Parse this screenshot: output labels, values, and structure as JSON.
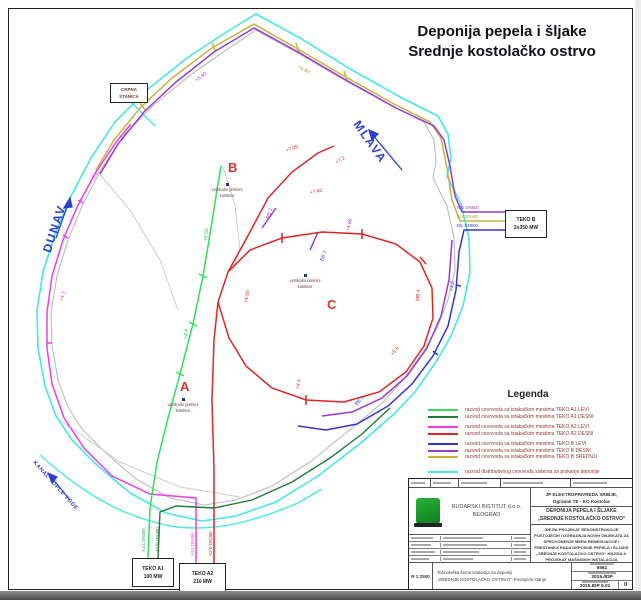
{
  "title": {
    "line1": "Deponija pepela i šljake",
    "line2": "Srednje kostolačko ostrvo"
  },
  "colors": {
    "teko_a1_levi": "#2ee05a",
    "teko_a1_desni": "#1f7a33",
    "teko_a2_levi": "#ee3cee",
    "teko_a2_desni": "#e02424",
    "teko_b_levi": "#3434d0",
    "teko_b_desni": "#9a3ad0",
    "teko_b_srednji": "#c8b23c",
    "distributivni": "#44e8e8",
    "region_letter": "#e03030",
    "river_text": "#2b3fd0"
  },
  "map": {
    "regions": {
      "a": "A",
      "b": "B",
      "c": "C"
    },
    "collector": {
      "line1": "vertikalni prelivni",
      "line2": "kolektor"
    },
    "rivers": {
      "dunav": "DUNAV",
      "mlava": "MLAVA",
      "kanal": "KANAL TOPLE VODE"
    },
    "stations": {
      "crpna": {
        "line1": "CRPNA",
        "line2": "STANICA"
      },
      "teko_b": {
        "line1": "TEKO B",
        "line2": "2x350 MW"
      },
      "teko_a1": {
        "line1": "TEKO A1",
        "line2": "100 MW"
      },
      "teko_a2": {
        "line1": "TEKO A2",
        "line2": "210 MW"
      }
    },
    "pipe_labels": {
      "b_d": "B/D DN500",
      "b_s": "B/S DN500",
      "b_l": "B/L DN500",
      "a1_l": "A1/L DN400",
      "a1_d": "A1/D DN400",
      "a2_l": "A2/L DN450",
      "a2_d": "A2/D DN450"
    },
    "annotations": [
      {
        "text": "+7.09",
        "color": "#e02424",
        "x": 286,
        "y": 148,
        "rot": -20
      },
      {
        "text": "+7.40",
        "color": "#e02424",
        "x": 310,
        "y": 190,
        "rot": -10
      },
      {
        "text": "+7.2",
        "color": "#e02424",
        "x": 336,
        "y": 160,
        "rot": -30
      },
      {
        "text": "+4.50",
        "color": "#e02424",
        "x": 246,
        "y": 300,
        "rot": -78
      },
      {
        "text": "+4.4",
        "color": "#e02424",
        "x": 298,
        "y": 386,
        "rot": -80
      },
      {
        "text": "+5.6",
        "color": "#e02424",
        "x": 392,
        "y": 352,
        "rot": -50
      },
      {
        "text": "MB 4",
        "color": "#e02424",
        "x": 418,
        "y": 298,
        "rot": -85
      },
      {
        "text": "+4.80",
        "color": "#9a3ad0",
        "x": 348,
        "y": 228,
        "rot": -75
      },
      {
        "text": "RB 2",
        "color": "#9a3ad0",
        "x": 268,
        "y": 216,
        "rot": -72
      },
      {
        "text": "BB 2",
        "color": "#9a3ad0",
        "x": 322,
        "y": 258,
        "rot": -70
      },
      {
        "text": "+5.90",
        "color": "#9a3ad0",
        "x": 196,
        "y": 78,
        "rot": -35
      },
      {
        "text": "+6.80",
        "color": "#b8a226",
        "x": 298,
        "y": 64,
        "rot": 28
      },
      {
        "text": "+6.60",
        "color": "#22b04b",
        "x": 206,
        "y": 238,
        "rot": -85
      },
      {
        "text": "+4.4",
        "color": "#22b04b",
        "x": 186,
        "y": 336,
        "rot": -85
      },
      {
        "text": "+4.2",
        "color": "#ee3cee",
        "x": 62,
        "y": 298,
        "rot": -78
      },
      {
        "text": "+5.2",
        "color": "#ee3cee",
        "x": 92,
        "y": 178,
        "rot": -58
      },
      {
        "text": "BB 1",
        "color": "#3434d0",
        "x": 356,
        "y": 402,
        "rot": -48
      },
      {
        "text": "+4.6",
        "color": "#3434d0",
        "x": 452,
        "y": 288,
        "rot": -85
      }
    ]
  },
  "legend": {
    "title": "Legenda",
    "items": [
      {
        "label": "razvod cevovoda sa istakačkim mestima TEKO A1 LEVI",
        "color": "#2ee05a"
      },
      {
        "label": "razvod cevovoda sa istakačkim mestima TEKO A1 DESNI",
        "color": "#1f7a33"
      },
      {
        "label": "razvod cevovoda sa istakačkim mestima TEKO A2 LEVI",
        "color": "#ee3cee"
      },
      {
        "label": "razvod cevovoda sa istakačkim mestima TEKO A2 DESNI",
        "color": "#e02424"
      },
      {
        "label": "razvod cevovoda sa istakačkim mestima TEKO B LEVI",
        "color": "#3434d0"
      },
      {
        "label": "razvod cevovoda sa istakačkim mestima TEKO B DESNI",
        "color": "#9a3ad0"
      },
      {
        "label": "razvod cevovoda sa istakačkim mestima TEKO B SREDNJI",
        "color": "#c8b23c"
      },
      {
        "label": "razvod distributivnog cevovoda sistema za prskanje deponije",
        "color": "#44e8e8"
      }
    ]
  },
  "title_block": {
    "company_line1": "RUDARSKI INSTITUT d.o.o.",
    "company_line2": "BEOGRAD",
    "investor_line1": "JP ELEKTROPRIVREDA SRBIJE,",
    "investor_line2": "Ogranak TE - KO Kostolac",
    "object_line1": "DEPONIJA PEPELA I ŠLJAKE",
    "object_line2": "„SREDNJE KOSTOLAČKO OSTRVO“",
    "project": "IDEJNI PROJEKAT REKONSTRUKCIJE POSTOJEĆIH I IZGRADNJA NOVIH OBJEKATA ZA SPROVOĐENJE MERA REMEDIJACIJE I PRESTANKA RADA DEPONIJE PEPELA I ŠLJAKE „SREDNJE KOSTOLAČKO OSTRVO“ KNJIGA 6. PROJEKAT MAŠINSKIH INSTALACIJA",
    "drawing_title_line1": "Tehnološka šema istakanja na deponiji",
    "drawing_title_line2": "„SREDNJE KOSTOLAČKO OSTRVO“: Postojeće stanje",
    "scale": "R 1:2500",
    "project_no": "6561",
    "year": "2015./IDP",
    "drawing_no": "2015.IDP 6.01",
    "rev": "0"
  }
}
